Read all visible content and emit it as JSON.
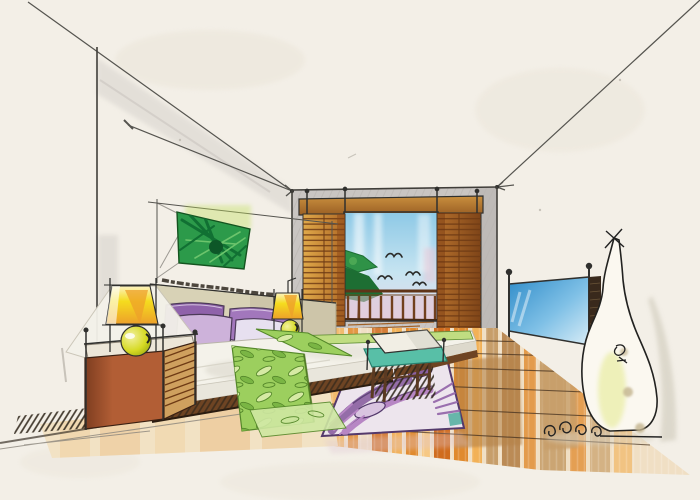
{
  "image": {
    "type": "hand-drawn interior design marker/watercolor sketch",
    "subject": "bedroom interior in one-point perspective with exposed construction guide lines",
    "width_px": 700,
    "height_px": 500
  },
  "scene": {
    "objects": [
      {
        "name": "left-wall",
        "description": "white wall with grey shading band under ceiling line"
      },
      {
        "name": "back-wall",
        "description": "grey washed wall containing window opening"
      },
      {
        "name": "wall-art",
        "description": "green palm-leaf abstract painting over headboard"
      },
      {
        "name": "headboard",
        "description": "beige headboard panel with scribbled ledge"
      },
      {
        "name": "pillows",
        "description": "two dark purple pillows behind, two light lilac pillows in front"
      },
      {
        "name": "bed",
        "description": "wide bed, white duvet, dark wood base"
      },
      {
        "name": "bed-runner",
        "description": "green leaf-pattern runner draped over near side of bed"
      },
      {
        "name": "nightstand",
        "description": "terracotta nightstand with rattan slat side"
      },
      {
        "name": "bedside-lamp-left",
        "description": "yellow trapezoid shade over yellow-green sphere base"
      },
      {
        "name": "bedside-lamp-right",
        "description": "small square yellow shade with green sphere on headboard"
      },
      {
        "name": "window-shutters",
        "description": "wood slat shutter panels flanking window"
      },
      {
        "name": "window-view",
        "description": "blue sky, white streaks, green tree, flying birds"
      },
      {
        "name": "balcony-railing",
        "description": "wood rail with vertical posts, pink wash behind"
      },
      {
        "name": "tv",
        "description": "blue flat screen on right wall in perspective"
      },
      {
        "name": "bench",
        "description": "foot-of-bed bench with teal cushion and wood legs"
      },
      {
        "name": "area-rug",
        "description": "purple floral patterned rug under bench"
      },
      {
        "name": "floor-sculpture",
        "description": "tall white curvy gourd sculpture with coil base"
      },
      {
        "name": "wood-floor",
        "description": "orange-amber plank floor with perspective grid lines"
      },
      {
        "name": "perspective-guide-lines",
        "description": "vanishing construction lines extending past the walls"
      }
    ],
    "counts": {
      "pillows": 4,
      "birds": 4,
      "railing_posts": 9,
      "lamps": 2
    },
    "style": "marker rendering on warm off-white paper, black fineliner outlines"
  },
  "palette": {
    "paper": "#f3efe7",
    "paperBlotch": "#e9e3d6",
    "wallShade": "#d7d3cd",
    "wallStrip": "#cfcbc5",
    "backWall": "#c9c5c2",
    "backWallDark": "#b9b5b2",
    "ink": "#30302e",
    "lineGrey": "#55544f",
    "headerWood1": "#c98f3e",
    "headerWood2": "#9a5f24",
    "shutGold1": "#e0a94a",
    "shutGold2": "#b06a26",
    "shutSien1": "#b5702c",
    "shutSien2": "#7e4418",
    "slatLine": "#6e3a14",
    "skyTop": "#8ec9e6",
    "skyMid": "#c6e4f1",
    "skyBot": "#e6d9e6",
    "skyPink": "#e9c6d6",
    "treeDark": "#1d6e33",
    "treeMid": "#2f9247",
    "treeLight": "#52ae57",
    "bird": "#2c2c2a",
    "railWood": "#5f3418",
    "railPost": "#71401e",
    "railWash": "#e2c2d3",
    "balconyPlank": "#a06228",
    "floorBase": "#f0dfc4",
    "floorOr1": "#f2b157",
    "floorOr2": "#e08a2e",
    "floorOr3": "#d06c1e",
    "floorGold": "#f6c884",
    "floorTan": "#c79e6a",
    "floorBlotch": "#b5824a",
    "floorLine": "#4a3522",
    "floorPale": "#f2e2c4",
    "shadowHatch": "#2f261a",
    "duvet": "#f4f2ea",
    "duvetShade": "#d9d6ca",
    "woodBase": "#6e4423",
    "headboard": "#d8d2b6",
    "pillowA": "#8f62aa",
    "pillowB": "#a277bc",
    "pillowC": "#cdb2da",
    "pillowD": "#e7e0f0",
    "pillowLine": "#4c3a58",
    "runner": "#9ccf5e",
    "runnerPale": "#bedc7c",
    "leafLight": "#d6eaa4",
    "leafMid": "#7ab544",
    "leafDark": "#55882a",
    "tailGreen": "#cfe8a2",
    "lampY1": "#fdf3c2",
    "lampY2": "#f5dc1e",
    "lampY3": "#eda02a",
    "sphere1": "#f2f0a0",
    "sphere2": "#d6da24",
    "sphere3": "#9aa80e",
    "nsTop": "#ece6d8",
    "nsFace1": "#b25e35",
    "nsFace2": "#7e3d20",
    "nsSlat": "#cfa05e",
    "benchTeal": "#58bfa7",
    "benchTealDark": "#27806e",
    "cushion": "#f1eee4",
    "rugBase": "#ede5ed",
    "rugPlum": "#8a5fa0",
    "rugLilac": "#b786c4",
    "rugViolet": "#9a6fae",
    "rugPale": "#d9c4e0",
    "rugLine": "#53396b",
    "rugTeal": "#4fae9e",
    "tv1": "#2f8cc9",
    "tv2": "#7fc0e6",
    "tv3": "#d9edf7",
    "tvStrip": "#39291c",
    "sculpt": "#fbf8f0",
    "sculptTint": "#e9eda2",
    "sculptBlotch": "#c3b48e",
    "sculptShadow": "#cbc6b6",
    "artG1": "#2c9a4a",
    "artG2": "#117033",
    "artG3": "#6cc46c",
    "artDark": "#0d5728",
    "artHalo": "#c2e05e",
    "white": "#ffffff"
  }
}
